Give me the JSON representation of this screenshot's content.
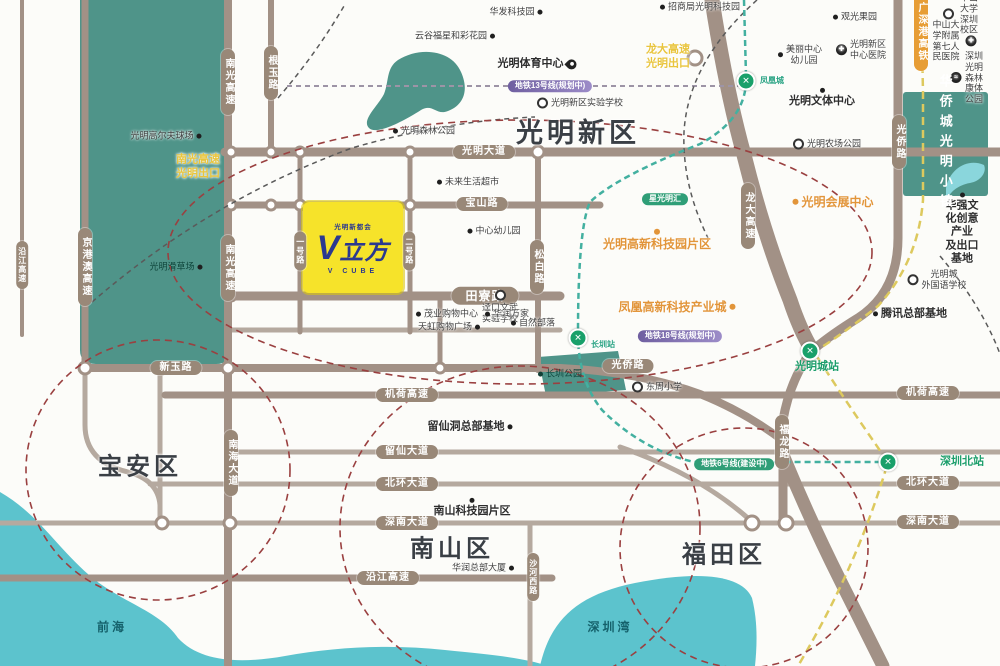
{
  "map": {
    "project": {
      "logo_top": "光明新都会",
      "logo_v": "V",
      "logo_cn": "立方",
      "logo_bottom": "V CUBE"
    },
    "colors": {
      "teal_block": "#4f9489",
      "water": "#5cc3cd",
      "road": "#a29186",
      "pill": "#998878",
      "project_yellow": "#f6e32a",
      "logo_navy": "#2b3990",
      "orange_poi": "#e2953a",
      "exit_yellow": "#e9c53e",
      "metro_green": "#19a06a",
      "boundary_red": "#9a4040",
      "rail_yellow": "#ddc95e",
      "metro_teal": "#43b0a0"
    },
    "labels": [
      {
        "id": "district-guangming",
        "t": "光明新区",
        "x": 578,
        "y": 133,
        "cls": "district lg"
      },
      {
        "id": "district-baoan",
        "t": "宝安区",
        "x": 140,
        "y": 468,
        "cls": "district"
      },
      {
        "id": "district-nanshan",
        "t": "南山区",
        "x": 452,
        "y": 550,
        "cls": "district"
      },
      {
        "id": "district-futian",
        "t": "福田区",
        "x": 724,
        "y": 556,
        "cls": "district"
      },
      {
        "id": "pill-guangming-dadao",
        "t": "光明大道",
        "x": 484,
        "y": 152,
        "cls": "pill"
      },
      {
        "id": "pill-baoshan-rd",
        "t": "宝山路",
        "x": 482,
        "y": 204,
        "cls": "pill"
      },
      {
        "id": "pill-tianliao-rd",
        "t": "田寮路",
        "x": 485,
        "y": 296,
        "cls": "pill lgp"
      },
      {
        "id": "pill-xinyu-rd",
        "t": "新玉路",
        "x": 176,
        "y": 368,
        "cls": "pill"
      },
      {
        "id": "pill-guangqiao-rd-h",
        "t": "光侨路",
        "x": 628,
        "y": 366,
        "cls": "pill"
      },
      {
        "id": "pill-jihe-expwy-left",
        "t": "机荷高速",
        "x": 407,
        "y": 395,
        "cls": "pill"
      },
      {
        "id": "pill-jihe-expwy-right",
        "t": "机荷高速",
        "x": 928,
        "y": 393,
        "cls": "pill"
      },
      {
        "id": "pill-liuxian-ave",
        "t": "留仙大道",
        "x": 407,
        "y": 452,
        "cls": "pill"
      },
      {
        "id": "pill-beihuan-ave-left",
        "t": "北环大道",
        "x": 407,
        "y": 484,
        "cls": "pill"
      },
      {
        "id": "pill-beihuan-ave-right",
        "t": "北环大道",
        "x": 928,
        "y": 483,
        "cls": "pill"
      },
      {
        "id": "pill-shennan-ave-left",
        "t": "深南大道",
        "x": 407,
        "y": 523,
        "cls": "pill"
      },
      {
        "id": "pill-shennan-ave-right",
        "t": "深南大道",
        "x": 928,
        "y": 522,
        "cls": "pill"
      },
      {
        "id": "pill-yanjiang-expwy-h",
        "t": "沿江高速",
        "x": 388,
        "y": 578,
        "cls": "pill"
      },
      {
        "id": "pill-yanjiang-expwy-v",
        "t": "沿江高速",
        "x": 22,
        "y": 265,
        "cls": "pill v smp"
      },
      {
        "id": "pill-jinggangao-expwy",
        "t": "京港澳高速",
        "x": 85,
        "y": 267,
        "cls": "pill v"
      },
      {
        "id": "pill-nanguang-expwy-top",
        "t": "南光高速",
        "x": 228,
        "y": 82,
        "cls": "pill v"
      },
      {
        "id": "pill-genyu-rd",
        "t": "根玉路",
        "x": 271,
        "y": 73,
        "cls": "pill v"
      },
      {
        "id": "pill-nanguang-expwy-mid",
        "t": "南光高速",
        "x": 228,
        "y": 268,
        "cls": "pill v"
      },
      {
        "id": "pill-nanhai-ave",
        "t": "南海大道",
        "x": 231,
        "y": 463,
        "cls": "pill v"
      },
      {
        "id": "pill-songbai-rd",
        "t": "松白路",
        "x": 537,
        "y": 267,
        "cls": "pill v"
      },
      {
        "id": "pill-longda-expwy",
        "t": "龙大高速",
        "x": 748,
        "y": 216,
        "cls": "pill v"
      },
      {
        "id": "pill-guangqiao-rd-v",
        "t": "光侨路",
        "x": 899,
        "y": 142,
        "cls": "pill v"
      },
      {
        "id": "pill-fulong-rd",
        "t": "福龙路",
        "x": 782,
        "y": 442,
        "cls": "pill v"
      },
      {
        "id": "pill-shahexi-rd",
        "t": "沙河西路",
        "x": 533,
        "y": 577,
        "cls": "pill v smp"
      },
      {
        "id": "pill-no1-rd",
        "t": "一号路",
        "x": 300,
        "y": 251,
        "cls": "pill v smp"
      },
      {
        "id": "pill-no2-rd",
        "t": "二号路",
        "x": 409,
        "y": 251,
        "cls": "pill v smp"
      },
      {
        "id": "pill-gsg-rail",
        "t": "广深港高铁",
        "x": 921,
        "y": 32,
        "cls": "pill v orangep"
      },
      {
        "id": "metro-line13-pill",
        "t": "地铁13号线(规划中)",
        "x": 550,
        "y": 86,
        "cls": "purplep"
      },
      {
        "id": "metro-line18-pill",
        "t": "地铁18号线(规划中)",
        "x": 680,
        "y": 336,
        "cls": "purplep"
      },
      {
        "id": "metro-line6-pill",
        "t": "地铁6号线(建设中)",
        "x": 734,
        "y": 464,
        "cls": "greenp"
      },
      {
        "id": "exit-nanguang",
        "t": "南光高速\n光明出口",
        "x": 198,
        "y": 167,
        "cls": "exit"
      },
      {
        "id": "exit-longda",
        "t": "龙大高速\n光明出口",
        "x": 668,
        "y": 57,
        "cls": "exit"
      },
      {
        "id": "poi-huafa-tech-park",
        "t": "华发科技园",
        "x": 516,
        "y": 12,
        "icon": "dot",
        "side": "right"
      },
      {
        "id": "poi-yungu-garden",
        "t": "云谷福星和彩花园",
        "x": 455,
        "y": 36,
        "icon": "dot",
        "side": "right"
      },
      {
        "id": "poi-guangming-sports-center",
        "t": "光明体育中心",
        "x": 537,
        "y": 64,
        "cls": "md",
        "icon": "pin",
        "side": "right"
      },
      {
        "id": "poi-gm-experimental-school",
        "t": "光明新区实验学校",
        "x": 580,
        "y": 103,
        "icon": "circle",
        "side": "left"
      },
      {
        "id": "poi-gm-forest-park",
        "t": "光明森林公园",
        "x": 424,
        "y": 131,
        "icon": "dot",
        "side": "left"
      },
      {
        "id": "poi-gm-golf-course",
        "t": "光明高尔夫球场",
        "x": 166,
        "y": 136,
        "icon": "dot",
        "side": "right"
      },
      {
        "id": "poi-gm-grass-ski",
        "t": "光明滑草场",
        "x": 176,
        "y": 267,
        "cls": "on-green",
        "icon": "dot",
        "side": "right"
      },
      {
        "id": "poi-future-life-market",
        "t": "未来生活超市",
        "x": 468,
        "y": 182,
        "icon": "dot",
        "side": "left"
      },
      {
        "id": "poi-center-kindergarten",
        "t": "中心幼儿园",
        "x": 494,
        "y": 231,
        "icon": "dot",
        "side": "left"
      },
      {
        "id": "poi-jingkou-school",
        "t": "迳口文武\n实验学校",
        "x": 500,
        "y": 307,
        "icon": "circle",
        "side": "top"
      },
      {
        "id": "poi-maoye-mall",
        "t": "茂业购物中心",
        "x": 447,
        "y": 314,
        "icon": "dot",
        "side": "left"
      },
      {
        "id": "poi-huarun-wanjia",
        "t": "华润万家",
        "x": 507,
        "y": 314,
        "icon": "dot",
        "side": "left"
      },
      {
        "id": "poi-tianhong-plaza",
        "t": "天虹购物广场",
        "x": 449,
        "y": 327,
        "icon": "dot",
        "side": "right"
      },
      {
        "id": "poi-nature-tribe",
        "t": "自然部落",
        "x": 533,
        "y": 323,
        "icon": "dot",
        "side": "left"
      },
      {
        "id": "poi-zhaoshangju-tech",
        "t": "招商局光明科技园",
        "x": 700,
        "y": 7,
        "icon": "dot",
        "side": "left"
      },
      {
        "id": "poi-guanguang-orchard",
        "t": "观光果园",
        "x": 855,
        "y": 17,
        "icon": "dot",
        "side": "left"
      },
      {
        "id": "poi-meili-kindergarten",
        "t": "美丽中心\n幼儿园",
        "x": 800,
        "y": 55,
        "icon": "dot",
        "side": "left"
      },
      {
        "id": "poi-gm-hospital",
        "t": "光明新区\n中心医院",
        "x": 861,
        "y": 50,
        "icon": "cross",
        "side": "left"
      },
      {
        "id": "poi-sysu-campus",
        "t": "中山大学深圳校区",
        "x": 962,
        "y": 14,
        "icon": "circle",
        "side": "left"
      },
      {
        "id": "poi-sysu-hospital",
        "t": "中山大学附属\n第七人民医院",
        "x": 953,
        "y": 41,
        "icon": "cross",
        "side": "right"
      },
      {
        "id": "poi-forest-wellness-park",
        "t": "深圳光明\n森林康体公园",
        "x": 967,
        "y": 78,
        "icon": "black",
        "side": "left"
      },
      {
        "id": "poi-huaqiang-base",
        "t": "华强文化创意产业\n及出口基地",
        "x": 962,
        "y": 229,
        "cls": "md",
        "icon": "dot",
        "side": "top"
      },
      {
        "id": "poi-tencent-hq",
        "t": "腾讯总部基地",
        "x": 910,
        "y": 314,
        "cls": "md",
        "icon": "dot",
        "side": "left"
      },
      {
        "id": "poi-gmc-foreign-school",
        "t": "光明城\n外国语学校",
        "x": 937,
        "y": 280,
        "icon": "circle",
        "side": "left"
      },
      {
        "id": "poi-dongzhou-school",
        "t": "东周小学",
        "x": 657,
        "y": 387,
        "icon": "circle",
        "side": "left"
      },
      {
        "id": "poi-changzhen-park",
        "t": "长圳公园",
        "x": 560,
        "y": 374,
        "cls": "on-green",
        "icon": "gdot",
        "side": "left"
      },
      {
        "id": "poi-liuxiandong-base",
        "t": "留仙洞总部基地",
        "x": 470,
        "y": 427,
        "cls": "md",
        "icon": "dot",
        "side": "right"
      },
      {
        "id": "poi-nanshan-tech-park",
        "t": "南山科技园片区",
        "x": 472,
        "y": 508,
        "cls": "md",
        "icon": "dot",
        "side": "top"
      },
      {
        "id": "poi-huarun-hq",
        "t": "华润总部大厦",
        "x": 483,
        "y": 568,
        "icon": "dot",
        "side": "right"
      },
      {
        "id": "poi-gm-exhibition-center",
        "t": "光明会展中心",
        "x": 833,
        "y": 202,
        "cls": "orange",
        "icon": "odot",
        "side": "left"
      },
      {
        "id": "poi-gm-hightech-zone",
        "t": "光明高新科技园片区",
        "x": 657,
        "y": 240,
        "cls": "orange",
        "icon": "odot",
        "side": "top"
      },
      {
        "id": "poi-phoenix-tech-city",
        "t": "凤凰高新科技产业城",
        "x": 677,
        "y": 307,
        "cls": "orange",
        "icon": "odot",
        "side": "right"
      },
      {
        "id": "poi-gm-culture-center",
        "t": "光明文体中心",
        "x": 822,
        "y": 98,
        "cls": "md",
        "icon": "dot",
        "side": "top"
      },
      {
        "id": "poi-gm-farm-park",
        "t": "光明农场公园",
        "x": 827,
        "y": 144,
        "icon": "circle",
        "side": "left"
      },
      {
        "id": "badge-xingguangming",
        "t": "星光明汇",
        "x": 665,
        "y": 199,
        "cls": "greenp",
        "icon": null,
        "side": "left"
      },
      {
        "id": "water-qianhai",
        "t": "前海",
        "x": 112,
        "y": 627,
        "cls": "water-lbl"
      },
      {
        "id": "water-shenzhen-bay",
        "t": "深圳湾",
        "x": 610,
        "y": 627,
        "cls": "water-lbl"
      },
      {
        "id": "area-oct-town",
        "t": "华侨城光明小镇",
        "x": 945,
        "y": 144,
        "cls": "area-v"
      }
    ],
    "stations": [
      {
        "id": "station-fenghuangcheng",
        "glyph": "✕",
        "x": 746,
        "y": 81,
        "label": "凤凰城",
        "lx": 772,
        "ly": 81,
        "lcls": "st-sm"
      },
      {
        "id": "station-changzhen",
        "glyph": "✕",
        "x": 578,
        "y": 338,
        "label": "长圳站",
        "lx": 603,
        "ly": 345,
        "lcls": "st-sm"
      },
      {
        "id": "station-guangmingcheng",
        "glyph": "✕",
        "x": 810,
        "y": 351,
        "label": "光明城站",
        "lx": 817,
        "ly": 367,
        "lcls": "station-lbl"
      },
      {
        "id": "station-shenzhenbei",
        "glyph": "✕",
        "x": 888,
        "y": 462,
        "label": "深圳北站",
        "lx": 962,
        "ly": 462,
        "lcls": "station-lbl"
      }
    ]
  }
}
